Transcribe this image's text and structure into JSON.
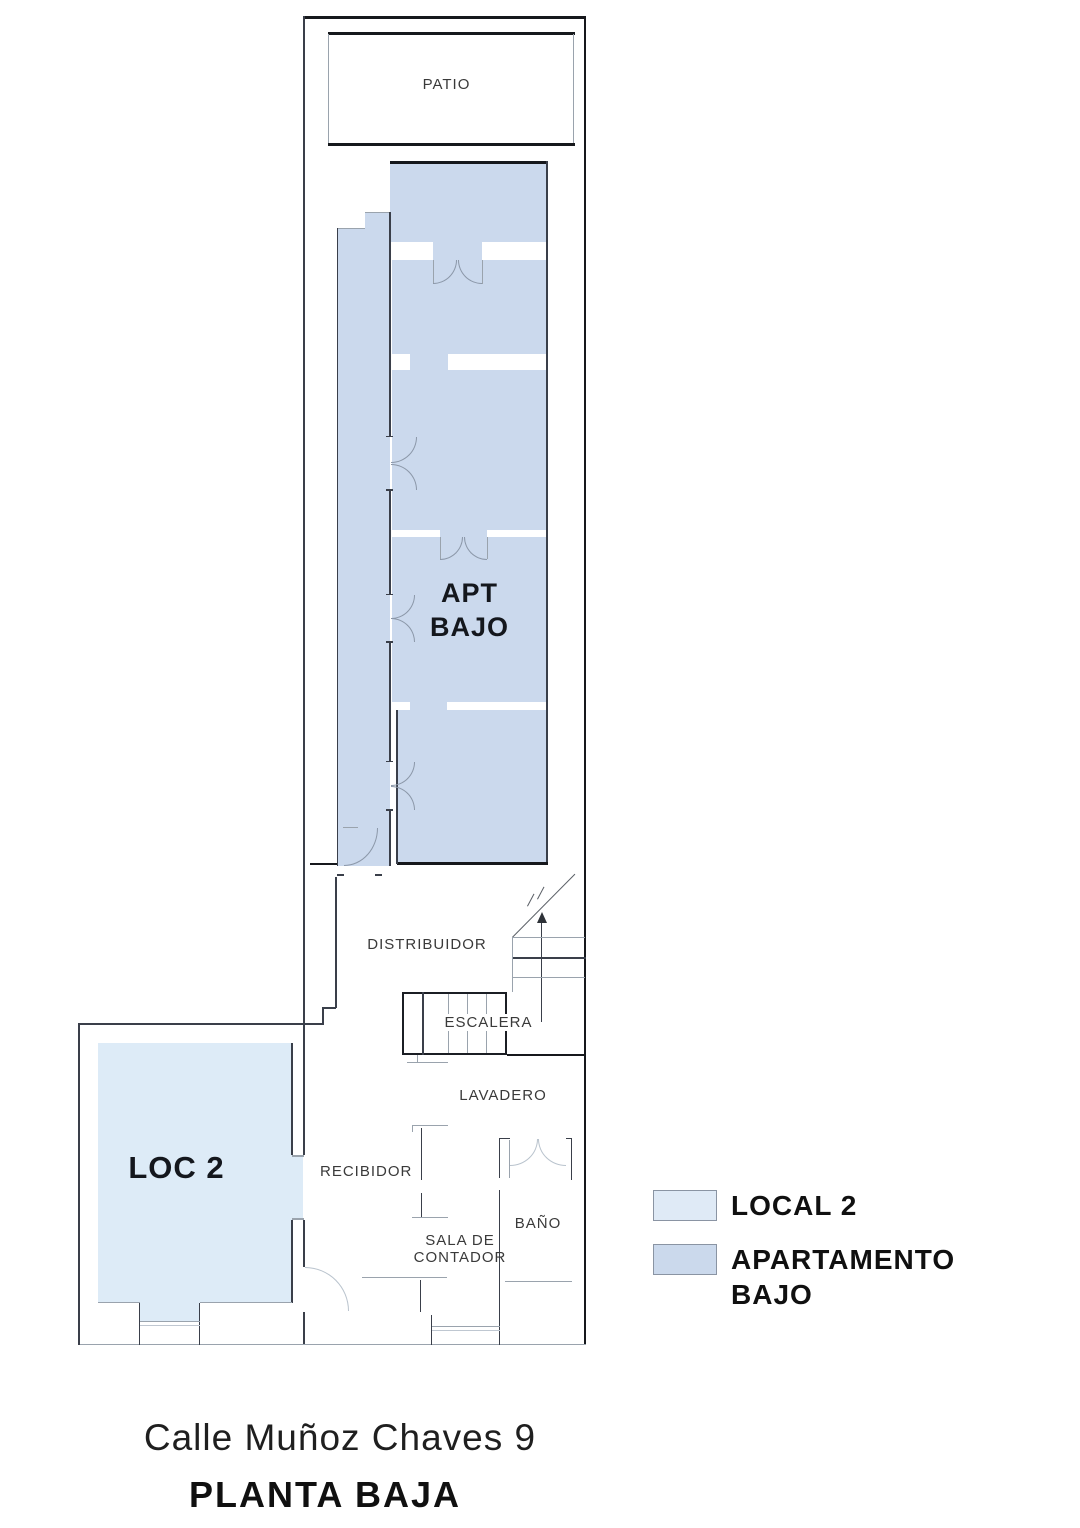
{
  "plan": {
    "rooms": {
      "patio": "PATIO",
      "apt_line1": "APT",
      "apt_line2": "BAJO",
      "distribuidor": "DISTRIBUIDOR",
      "escalera": "ESCALERA",
      "lavadero": "LAVADERO",
      "recibidor": "RECIBIDOR",
      "bano": "BAÑO",
      "sala_line1": "SALA DE",
      "sala_line2": "CONTADOR",
      "loc2": "LOC 2"
    },
    "colors": {
      "apartment_fill": "#cbd9ed",
      "local_fill": "#ddebf7",
      "wall_dark": "#16181c",
      "wall_medium": "#3a3f4a",
      "wall_gray": "#9aa3ad",
      "door_arc": "#8b97a8"
    }
  },
  "legend": {
    "items": [
      {
        "id": "local-2",
        "label": "LOCAL 2",
        "color": "#dfeaf6"
      },
      {
        "id": "apartamento-bajo",
        "label_line1": "APARTAMENTO",
        "label_line2": "BAJO",
        "color": "#cbd9ec"
      }
    ]
  },
  "footer": {
    "address": "Calle Muñoz Chaves 9",
    "floor": "PLANTA BAJA"
  }
}
